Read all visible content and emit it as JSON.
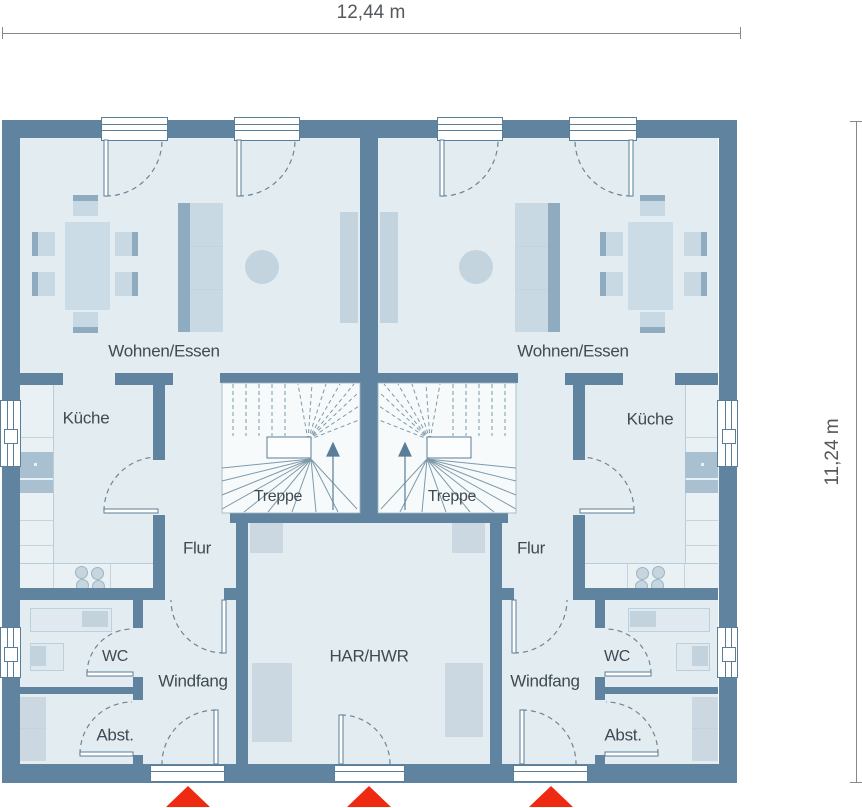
{
  "plan": {
    "dimension_width_label": "12,44 m",
    "dimension_height_label": "11,24 m",
    "units": {
      "left": {
        "living_label": "Wohnen/Essen",
        "kitchen_label": "Küche",
        "stairs_label": "Treppe",
        "hall_label": "Flur",
        "wc_label": "WC",
        "vestibule_label": "Windfang",
        "storage_label": "Abst."
      },
      "right": {
        "living_label": "Wohnen/Essen",
        "kitchen_label": "Küche",
        "stairs_label": "Treppe",
        "hall_label": "Flur",
        "wc_label": "WC",
        "vestibule_label": "Windfang",
        "storage_label": "Abst."
      },
      "shared": {
        "utility_label": "HAR/HWR"
      }
    },
    "entrance_marker_count": 3,
    "colors": {
      "wall": "#60849f",
      "room_fill": "#e3edf1",
      "stair_fill": "#f6fafb",
      "furniture_light": "#c9d9e4",
      "furniture_dark": "#8fabc0",
      "cabinet": "#ccd8e1",
      "entrance_marker_red": "#ee2b12",
      "label_text": "#3f4a52"
    }
  }
}
